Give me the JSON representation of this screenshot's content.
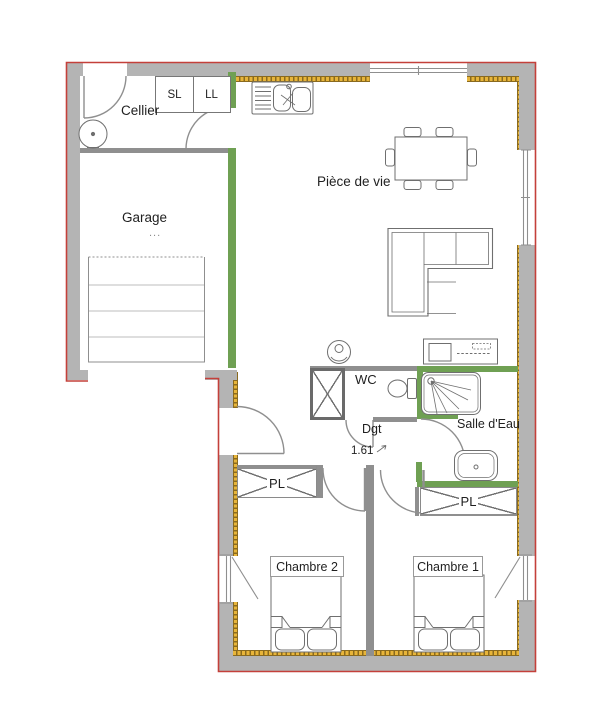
{
  "colors": {
    "background": "#ffffff",
    "wall": "#b4b4b4",
    "partition": "#8f8f8f",
    "green_wall": "#6fa053",
    "insulation": "#e8b53a",
    "insulation_dark": "#8a6a1f",
    "outline": "#c4403a",
    "furniture_line": "#6f6f6f",
    "door_line": "#8f8f8f",
    "text": "#1f1f1f",
    "box_border": "#999999"
  },
  "rooms": {
    "cellier": {
      "label": "Cellier"
    },
    "garage": {
      "label": "Garage",
      "dots": "..."
    },
    "piece_de_vie": {
      "label": "Pièce de vie"
    },
    "wc": {
      "label": "WC"
    },
    "degagement": {
      "label": "Dgt",
      "dimension": "1.61"
    },
    "salle_deau": {
      "label": "Salle d'Eau"
    },
    "chambre_1": {
      "label": "Chambre 1"
    },
    "chambre_2": {
      "label": "Chambre 2"
    },
    "placard_left": {
      "label": "PL"
    },
    "placard_right": {
      "label": "PL"
    }
  },
  "appliances": {
    "seche_linge": {
      "label": "SL"
    },
    "lave_linge": {
      "label": "LL"
    }
  }
}
